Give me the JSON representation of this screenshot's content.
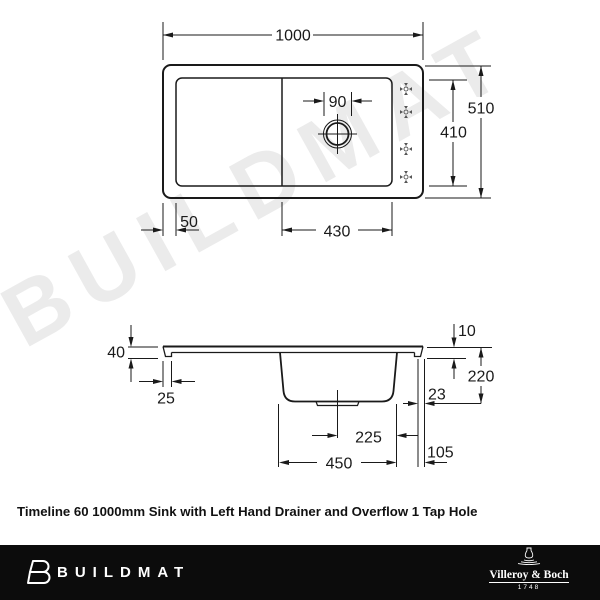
{
  "watermark_text": "BUILDMAT",
  "caption": "Timeline 60 1000mm Sink with Left Hand Drainer and Overflow 1 Tap Hole",
  "top_view": {
    "dim_width": "1000",
    "dim_overall_depth": "510",
    "dim_inner_depth": "410",
    "dim_tap_hole": "90",
    "dim_left_margin": "50",
    "dim_bowl_section_width": "430"
  },
  "side_view": {
    "dim_rim_height": "40",
    "dim_left_edge": "25",
    "dim_edge_lip": "10",
    "dim_bowl_depth": "220",
    "dim_edge_gap": "23",
    "dim_drain_offset": "225",
    "dim_bowl_width": "450",
    "dim_right_offset": "105"
  },
  "footer": {
    "brand": "BUILDMAT",
    "maker_name": "Villeroy & Boch",
    "maker_year": "1748"
  },
  "colors": {
    "line": "#1a1a1a",
    "watermark": "#ebebeb",
    "footer_bg": "#0c0c0c",
    "footer_text": "#ffffff"
  }
}
